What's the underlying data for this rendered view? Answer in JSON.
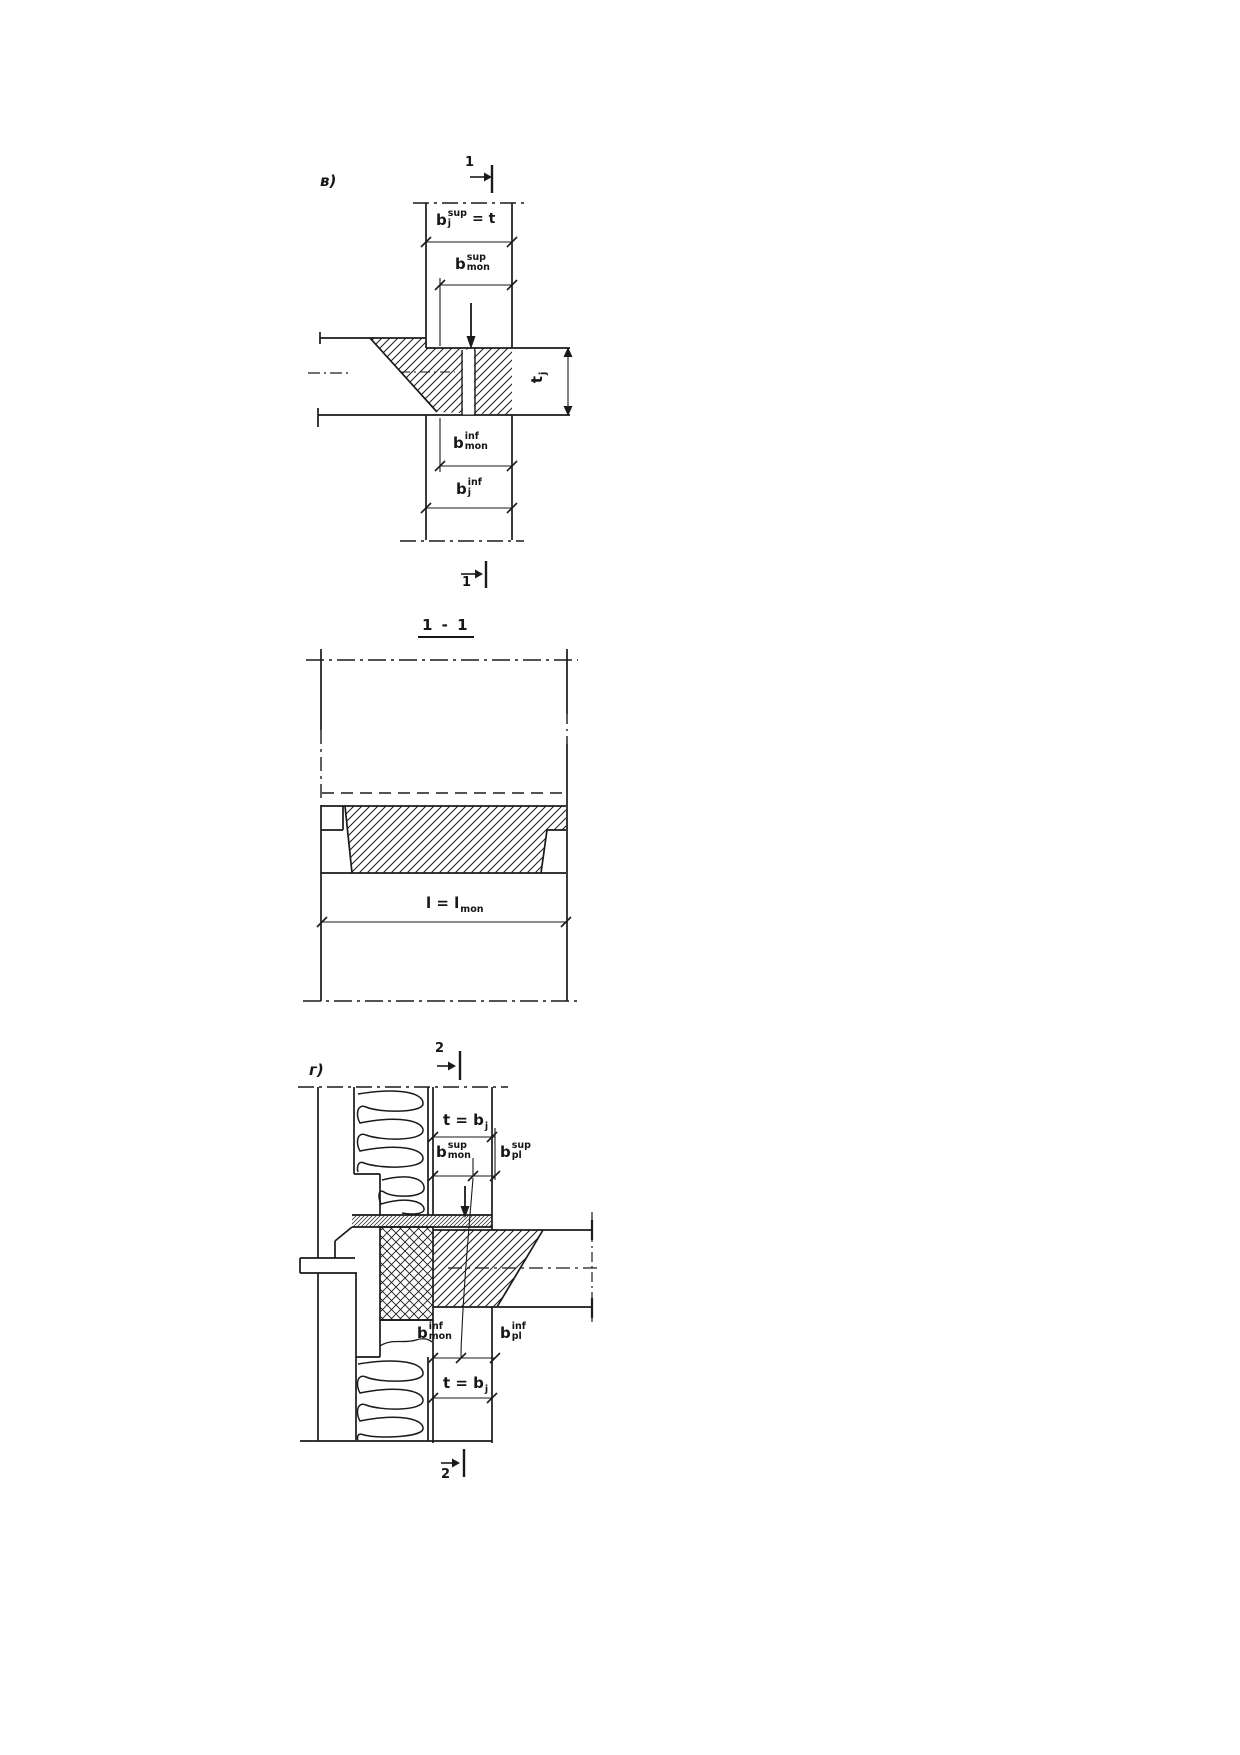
{
  "page": {
    "background": "#ffffff",
    "ink": "#1a1a1a"
  },
  "diagram_top": {
    "panel_label": "в)",
    "section_mark_top": "1",
    "section_mark_bottom": "1",
    "dim_bj_sup": {
      "base": "b",
      "sup": "sup",
      "sub": "j",
      "suffix": "= t"
    },
    "dim_bmon_sup": {
      "base": "b",
      "sup": "sup",
      "sub": "mon"
    },
    "dim_tj": {
      "base": "t",
      "sub": "j"
    },
    "dim_bmon_inf": {
      "base": "b",
      "sup": "inf",
      "sub": "mon"
    },
    "dim_bj_inf": {
      "base": "b",
      "sup": "inf",
      "sub": "j"
    }
  },
  "diagram_middle": {
    "title": "1 - 1",
    "dim_length": {
      "base": "l = l",
      "sub": "mon"
    }
  },
  "diagram_bottom": {
    "panel_label": "г)",
    "section_mark_top": "2",
    "section_mark_bottom": "2",
    "dim_t_bj_top": {
      "base": "t = b",
      "sub": "j"
    },
    "dim_bmon_sup": {
      "base": "b",
      "sup": "sup",
      "sub": "mon"
    },
    "dim_bpl_sup": {
      "base": "b",
      "sup": "sup",
      "sub": "pl"
    },
    "dim_bmon_inf": {
      "base": "b",
      "sup": "inf",
      "sub": "mon"
    },
    "dim_bpl_inf": {
      "base": "b",
      "sup": "inf",
      "sub": "pl"
    },
    "dim_t_bj_bottom": {
      "base": "t = b",
      "sub": "j"
    }
  }
}
